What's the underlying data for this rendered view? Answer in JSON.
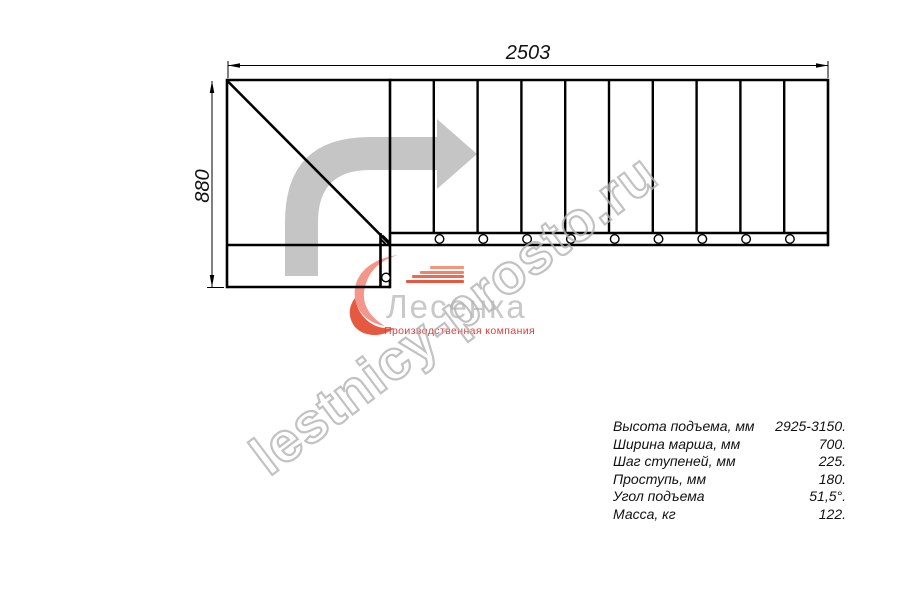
{
  "drawing": {
    "width_label": "2503",
    "height_label": "880"
  },
  "watermark": {
    "text": "lestnicy-prosto.ru",
    "color": "#b3b3b3"
  },
  "logo": {
    "name": "Лесенка",
    "tagline": "Производственная компания",
    "accent_color": "#e23b3b",
    "swirl_colors": [
      "#f4978a",
      "#e4593f"
    ]
  },
  "icons": {
    "direction_arrow": "bent-arrow-right",
    "direction_arrow_color": "#c5c5c5"
  },
  "specs": {
    "rows": [
      {
        "label": "Высота подъема, мм",
        "value": "2925-3150."
      },
      {
        "label": "Ширина марша, мм",
        "value": "700."
      },
      {
        "label": "Шаг ступеней, мм",
        "value": "225."
      },
      {
        "label": "Проступь, мм",
        "value": "180."
      },
      {
        "label": "Угол подъема",
        "value": "51,5°."
      },
      {
        "label": "Масса, кг",
        "value": "122."
      }
    ]
  }
}
